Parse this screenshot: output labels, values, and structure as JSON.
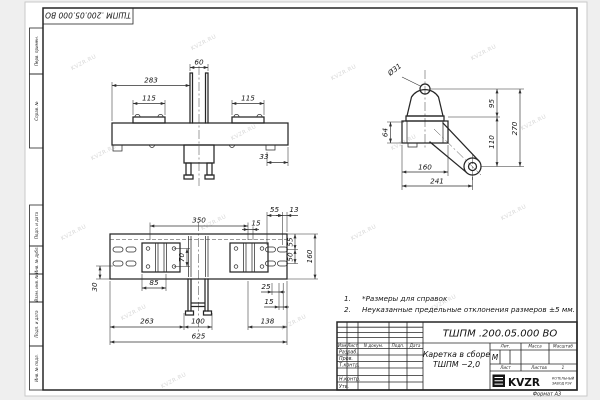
{
  "page": {
    "watermark": "KVZR.RU",
    "format_label": "Формат А3"
  },
  "margin": {
    "top_stamp": "ТШПМ .200.05.000  ВО",
    "box1": "Перв. примен.",
    "box2": "Справ. №",
    "box3": "Подп. и дата",
    "box4": "Инв. № дубл.",
    "box5": "Взам. инв. №",
    "box6": "Подп. и дата",
    "box7": "Инв. № подл."
  },
  "notes": {
    "n1_num": "1.",
    "n1_text": "*Размеры для справок",
    "n2_num": "2.",
    "n2_text": "Неуказанные предельные отклонения размеров  ±5 мм."
  },
  "title_block": {
    "designation": "ТШПМ .200.05.000  ВО",
    "name_line1": "Каретка в сборе",
    "name_line2": "ТШПМ −2,0",
    "hdr_izm": "Изм",
    "hdr_list": "Лист",
    "hdr_ndoc": "N докум.",
    "hdr_podp": "Подп.",
    "hdr_data": "Дата",
    "row_razrab": "Разраб.",
    "row_prov": "Пров.",
    "row_tkontr": "Т.контр.",
    "row_nkontr": "Н.контр.",
    "row_utv": "Утв.",
    "hdr_lit": "Лит.",
    "hdr_massa": "Масса",
    "hdr_masshtab": "Масштаб",
    "lit_value": "М",
    "sheet_label": "Лист",
    "sheets_label": "Листов",
    "sheets_value": "1",
    "logo_text": "KVZR",
    "logo_sub1": "КОТЕЛЬНЫЙ",
    "logo_sub2": "ЗАВОД РЭУ"
  },
  "views": {
    "front": {
      "d60": "60",
      "d283": "283",
      "d115l": "115",
      "d115r": "115",
      "d33": "33"
    },
    "side": {
      "dia31": "Ø31",
      "d95": "95",
      "d110": "110",
      "d270": "270",
      "d64": "64",
      "d160": "160",
      "d241": "241"
    },
    "plan": {
      "d350": "350",
      "d15t": "15",
      "d55t": "55",
      "d13": "13",
      "d55r": "55",
      "d50r": "50",
      "d160r": "160",
      "d70": "70",
      "d85": "85",
      "d30": "30",
      "d25": "25",
      "d15b": "15",
      "d263": "263",
      "d100": "100",
      "d138": "138",
      "d625": "625"
    }
  }
}
